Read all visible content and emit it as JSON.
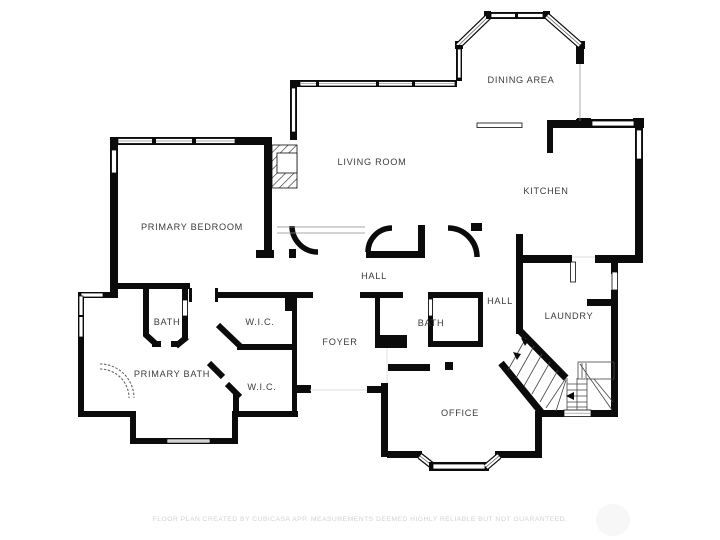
{
  "title": "Floor plan",
  "colors": {
    "background": "#ffffff",
    "walls": "#0b0b0b",
    "room_labels": "#3c3c3c",
    "footer_text": "#d2d2d2"
  },
  "rooms": [
    {
      "name": "dining-area",
      "label": "DINING AREA"
    },
    {
      "name": "living-room",
      "label": "LIVING ROOM"
    },
    {
      "name": "kitchen",
      "label": "KITCHEN"
    },
    {
      "name": "primary-bedroom",
      "label": "PRIMARY BEDROOM"
    },
    {
      "name": "hall-main",
      "label": "HALL"
    },
    {
      "name": "hall-rear",
      "label": "HALL"
    },
    {
      "name": "bath-suite",
      "label": "BATH"
    },
    {
      "name": "wic-upper",
      "label": "W.I.C."
    },
    {
      "name": "bath-hall",
      "label": "BATH"
    },
    {
      "name": "laundry",
      "label": "LAUNDRY"
    },
    {
      "name": "foyer",
      "label": "FOYER"
    },
    {
      "name": "primary-bath",
      "label": "PRIMARY BATH"
    },
    {
      "name": "wic-lower",
      "label": "W.I.C."
    },
    {
      "name": "office",
      "label": "OFFICE"
    }
  ],
  "features": [
    "fireplace",
    "curved-shower",
    "staircase-with-winders",
    "dining-bay-window",
    "office-bay-window"
  ],
  "footer": {
    "text": "FLOOR PLAN CREATED BY CUBICASA APP. MEASUREMENTS DEEMED HIGHLY RELIABLE BUT NOT GUARANTEED."
  }
}
